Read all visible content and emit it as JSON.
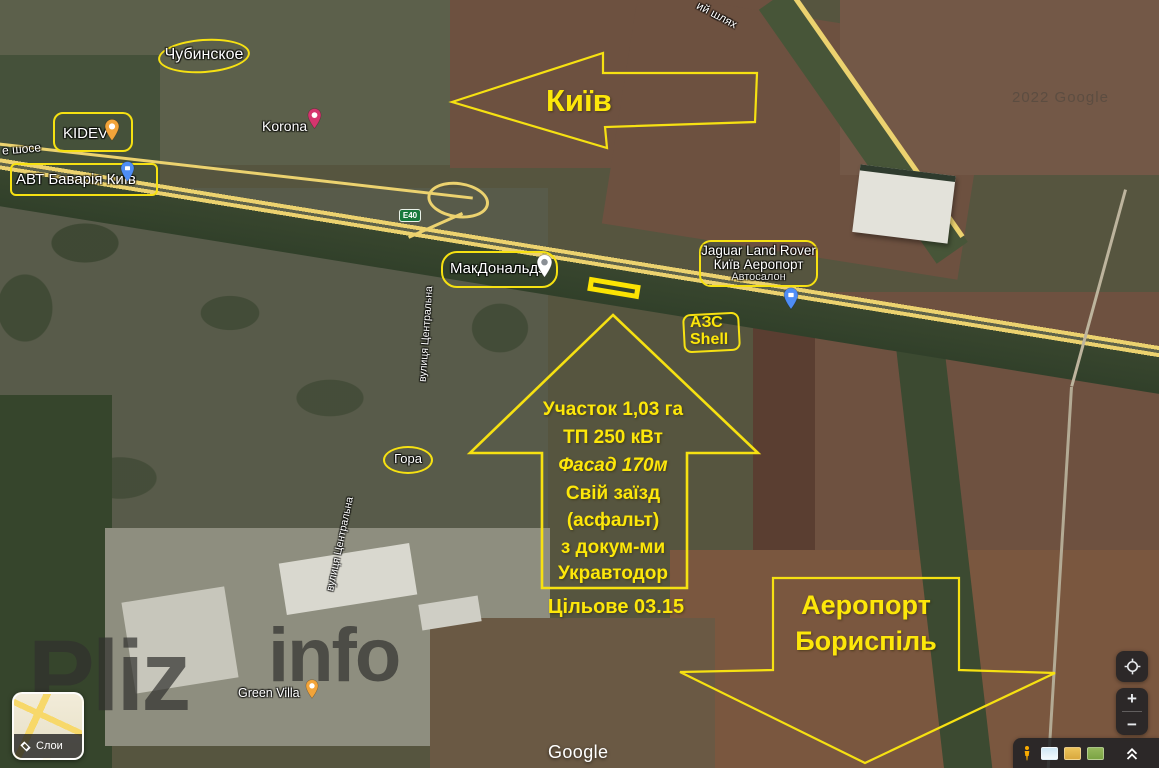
{
  "colors": {
    "annotation_yellow": "#f6e112"
  },
  "poi": {
    "chubynske": "Чубинское",
    "kidev": "KIDEV",
    "korona": "Korona",
    "avt_bavaria": "АВТ Баварія Київ",
    "mcdonalds": "МакДональдз",
    "jaguar_line1": "Jaguar Land Rover",
    "jaguar_line2": "Київ Аеропорт",
    "jaguar_line3": "Автосалон",
    "azs_line1": "АЗС",
    "azs_line2": "Shell",
    "hora": "Гора",
    "green_villa": "Green Villa"
  },
  "roads": {
    "e40_shield": "E40",
    "shose_label": "е шосе",
    "shliakh_label": "ий шлях",
    "central_street": "вулиця Центральна"
  },
  "callouts": {
    "kyiv_label": "Київ",
    "airport_line1": "Аеропорт",
    "airport_line2": "Бориспіль",
    "plot_line1": "Участок 1,03 га",
    "plot_line2": "ТП 250 кВт",
    "plot_line3": "Фасад 170м",
    "plot_line4": "Свій заїзд",
    "plot_line5": "(асфальт)",
    "plot_line6": "з докум-ми",
    "plot_line7": "Укравтодор",
    "zoning_label": "Цільове 03.15"
  },
  "watermark": {
    "brand_bold": "Pliz",
    "brand_light": "info",
    "imagery_credit": "2022 Google"
  },
  "google_ui": {
    "logo": "Google",
    "layers_label": "Слои",
    "zoom_in": "+",
    "zoom_out": "−"
  }
}
